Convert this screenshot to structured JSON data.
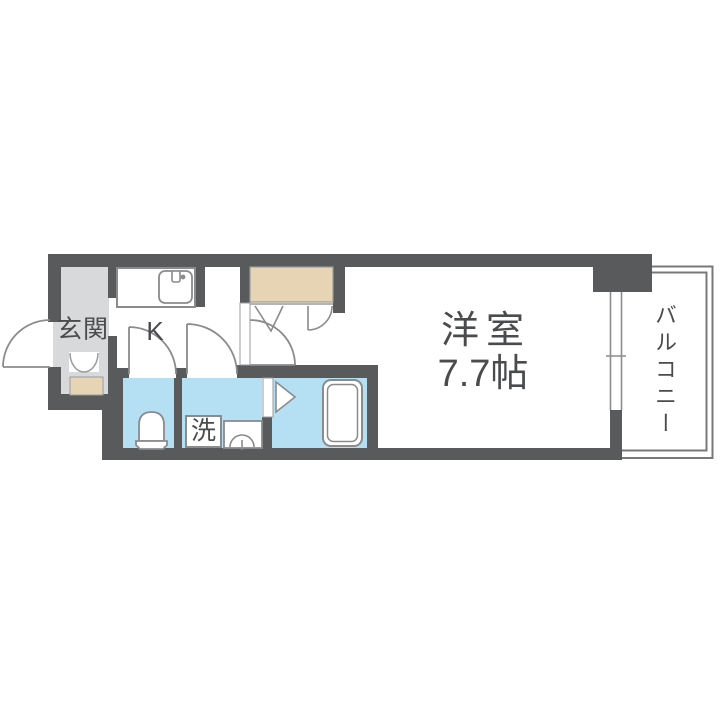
{
  "floorplan": {
    "type": "apartment-floorplan-1K",
    "labels": {
      "entrance": "玄関",
      "kitchen": "K",
      "room_name": "洋室",
      "room_size": "7.7帖",
      "balcony": "バルコニー",
      "laundry": "洗"
    },
    "colors": {
      "wall": "#595a5c",
      "entrance_floor": "#d8d9da",
      "wet_area": "#b5e0f3",
      "closet_fill": "#e7d4b4",
      "fixture_line": "#8a8b8d",
      "thin_line": "#9a9b9d",
      "balcony_line": "#77787a",
      "text": "#4a4b4d",
      "bg": "#ffffff"
    }
  }
}
